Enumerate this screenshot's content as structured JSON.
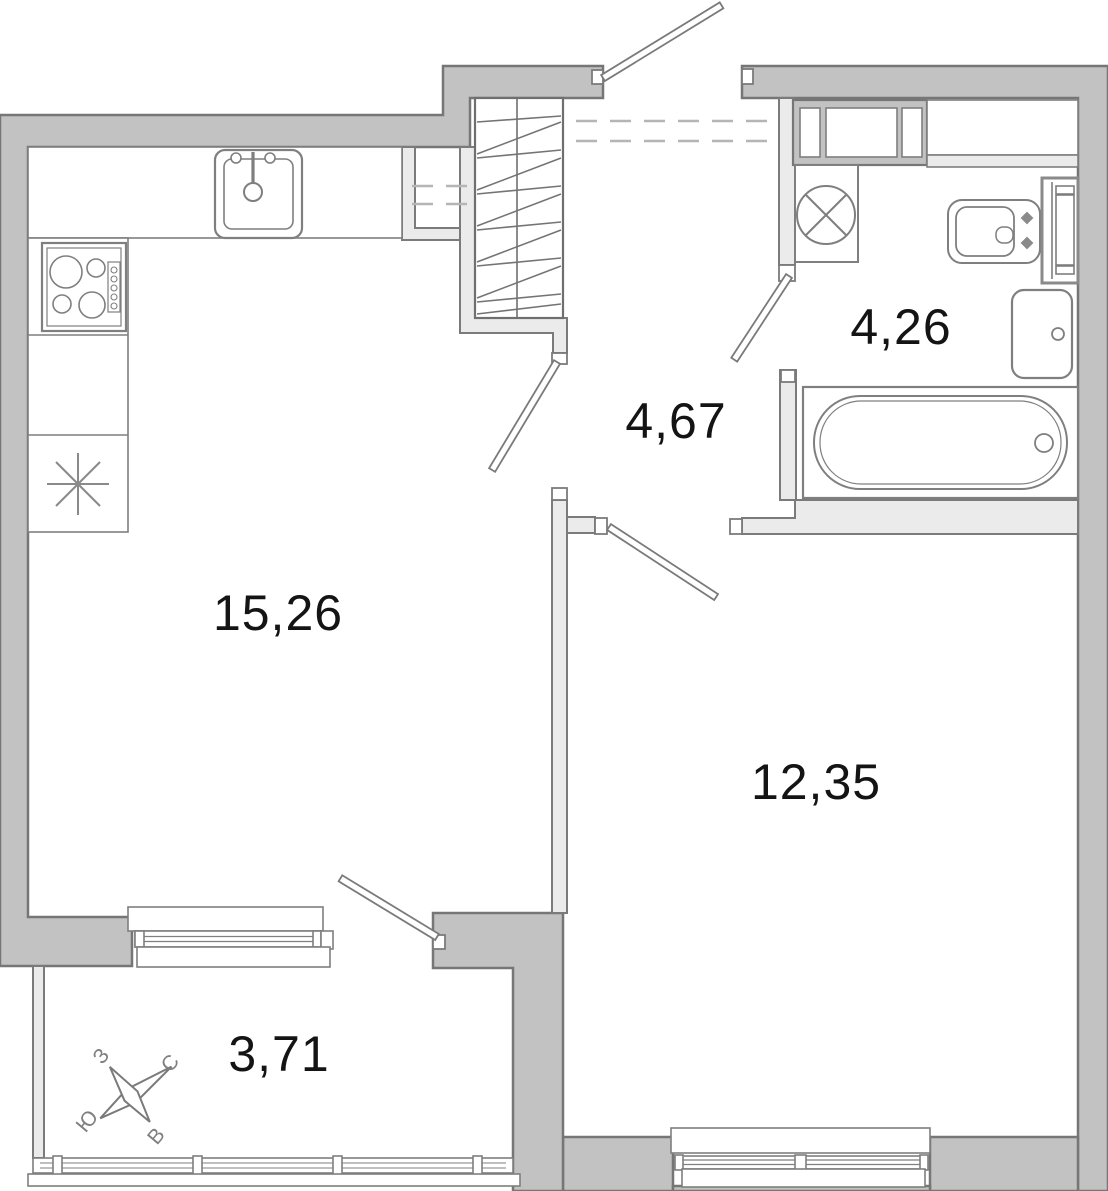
{
  "plan": {
    "type": "apartment-floor-plan",
    "rooms": [
      {
        "name": "kitchen-living-room",
        "area": "15,26"
      },
      {
        "name": "hallway",
        "area": "4,67"
      },
      {
        "name": "bathroom",
        "area": "4,26"
      },
      {
        "name": "bedroom",
        "area": "12,35"
      },
      {
        "name": "balcony",
        "area": "3,71"
      }
    ],
    "compass": {
      "north": "С",
      "east": "В",
      "south": "Ю",
      "west": "З"
    },
    "colors": {
      "wall_fill": "#c2c2c2",
      "wall_stroke": "#767676",
      "partition_fill": "#ebebeb",
      "partition_stroke": "#7b7b7b",
      "fixture_stroke": "#7f7f7f",
      "hatch_line": "#747474",
      "dashed_line": "#b5b5b5",
      "label_text": "#141414",
      "background": "#ffffff"
    }
  }
}
